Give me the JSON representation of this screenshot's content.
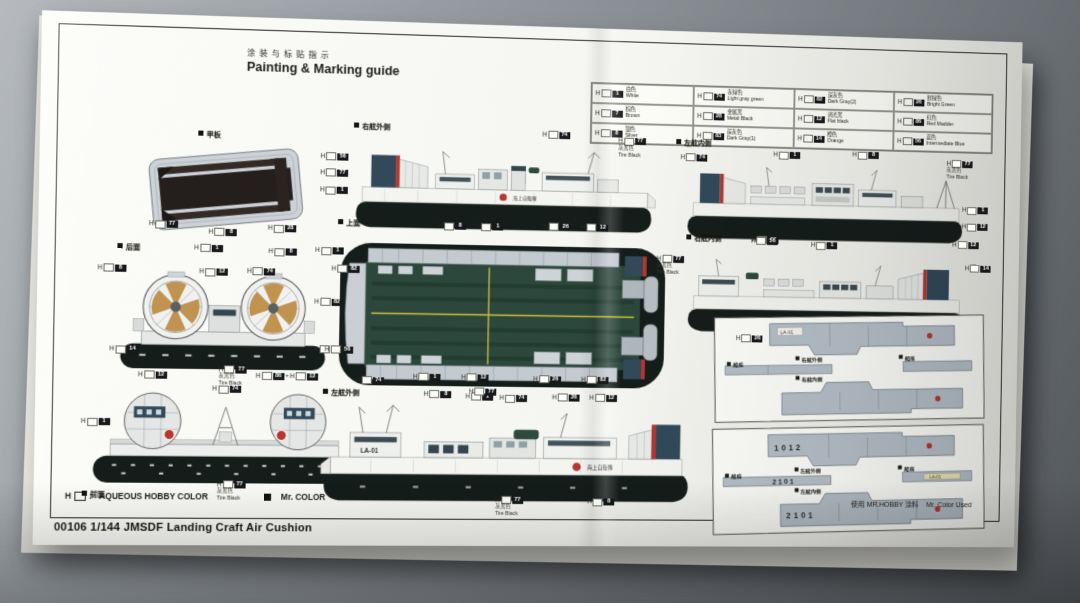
{
  "sheet": {
    "title": {
      "cn": "涂装与标贴指示",
      "en": "Painting & Marking guide"
    },
    "legend": {
      "prefix": "H",
      "aqueous": "AQUEOUS HOBBY COLOR",
      "mr_color": "Mr. COLOR"
    },
    "colors": {
      "skirt_black": "#151d1b",
      "deck_green": "#2c473c",
      "stern_teal": "#32495a",
      "marking_red": "#b5372f",
      "propeller_tan": "#c0934f",
      "lane_yellow": "#d4bf3e"
    },
    "paint_table": {
      "cells": [
        {
          "num": "1",
          "cn": "白色",
          "en": "White"
        },
        {
          "num": "74",
          "cn": "灰绿色",
          "en": "Light gray green"
        },
        {
          "num": "82",
          "cn": "深灰色",
          "en": "Dark Gray(2)"
        },
        {
          "num": "26",
          "cn": "鲜绿色",
          "en": "Bright Green"
        },
        {
          "num": "7",
          "cn": "棕色",
          "en": "Brown"
        },
        {
          "num": "28",
          "cn": "金属黑",
          "en": "Metal Black"
        },
        {
          "num": "12",
          "cn": "消光黑",
          "en": "Flat black"
        },
        {
          "num": "86",
          "cn": "红色",
          "en": "Red Madder"
        },
        {
          "num": "8",
          "cn": "银色",
          "en": "Silver"
        },
        {
          "num": "83",
          "cn": "深灰色",
          "en": "Dark Gray(1)"
        },
        {
          "num": "14",
          "cn": "橙色",
          "en": "Orange"
        },
        {
          "num": "56",
          "cn": "蓝色",
          "en": "Intermediate Blue"
        }
      ]
    },
    "views": {
      "deck": {
        "label": "甲板",
        "callouts": [
          {
            "x": 10,
            "y": 80,
            "num": "77"
          },
          {
            "x": 42,
            "y": 86,
            "num": "8"
          },
          {
            "x": 74,
            "y": 82,
            "num": "28"
          }
        ]
      },
      "starboard_out": {
        "label": "右舷外侧",
        "hull_text": "海上自衛隊",
        "callouts": [
          {
            "x": 1,
            "y": 28,
            "num": "56"
          },
          {
            "x": 1,
            "y": 42,
            "num": "77"
          },
          {
            "x": 1,
            "y": 58,
            "num": "1"
          },
          {
            "x": 64,
            "y": 4,
            "num": "74"
          },
          {
            "x": 86,
            "y": 8,
            "num": "77",
            "note_cn": "灰黑色",
            "note_en": "Tire Black"
          }
        ]
      },
      "port_in": {
        "label": "左舷内侧",
        "callouts": [
          {
            "x": 6,
            "y": 14,
            "num": "74"
          },
          {
            "x": 34,
            "y": 10,
            "num": "1"
          },
          {
            "x": 58,
            "y": 8,
            "num": "8"
          },
          {
            "x": 87,
            "y": 14,
            "num": "77",
            "note_cn": "灰黑色",
            "note_en": "Tire Black"
          },
          {
            "x": 92,
            "y": 58,
            "num": "1"
          },
          {
            "x": 92,
            "y": 74,
            "num": "12"
          },
          {
            "x": 28,
            "y": 90,
            "num": "56"
          }
        ]
      },
      "top": {
        "label": "上面",
        "callouts": [
          {
            "x": 32,
            "y": 1,
            "num": "8"
          },
          {
            "x": 42,
            "y": 1,
            "num": "1"
          },
          {
            "x": 60,
            "y": 0,
            "num": "26"
          },
          {
            "x": 70,
            "y": 0,
            "num": "12"
          },
          {
            "x": 0,
            "y": 16,
            "num": "1"
          },
          {
            "x": 0,
            "y": 44,
            "num": "82"
          },
          {
            "x": 0,
            "y": 70,
            "num": "8"
          },
          {
            "x": 29,
            "y": 94,
            "num": "8"
          },
          {
            "x": 40,
            "y": 95,
            "num": "1"
          },
          {
            "x": 49,
            "y": 96,
            "num": "74"
          },
          {
            "x": 63,
            "y": 95,
            "num": "26"
          },
          {
            "x": 73,
            "y": 95,
            "num": "12"
          }
        ]
      },
      "starboard_in": {
        "label": "右舷内侧",
        "callouts": [
          {
            "x": 0,
            "y": 20,
            "num": "77",
            "note_cn": "灰黑色",
            "note_en": "Tire Black"
          },
          {
            "x": 28,
            "y": 2,
            "num": "56"
          },
          {
            "x": 46,
            "y": 5,
            "num": "1"
          },
          {
            "x": 89,
            "y": 2,
            "num": "12"
          },
          {
            "x": 93,
            "y": 24,
            "num": "14"
          },
          {
            "x": 24,
            "y": 92,
            "num": "26"
          }
        ]
      },
      "rear": {
        "label": "后面",
        "callouts": [
          {
            "x": 38,
            "y": 0,
            "num": "1"
          },
          {
            "x": 66,
            "y": 2,
            "num": "8"
          },
          {
            "x": 2,
            "y": 15,
            "num": "8"
          },
          {
            "x": 40,
            "y": 17,
            "num": "12"
          },
          {
            "x": 58,
            "y": 16,
            "num": "74"
          },
          {
            "x": 90,
            "y": 13,
            "num": "82"
          },
          {
            "x": 7,
            "y": 72,
            "num": "14"
          },
          {
            "x": 88,
            "y": 70,
            "num": "56"
          },
          {
            "x": 48,
            "y": 85,
            "num": "77",
            "note_cn": "灰黑色",
            "note_en": "Tire Black"
          }
        ]
      },
      "front": {
        "label": "前面",
        "callouts": [
          {
            "x": 20,
            "y": 1,
            "num": "12"
          },
          {
            "x": 58,
            "y": 1,
            "num": "86",
            "num2": "12"
          },
          {
            "x": 2,
            "y": 36,
            "num": "1"
          },
          {
            "x": 44,
            "y": 11,
            "num": "74"
          },
          {
            "x": 46,
            "y": 82,
            "num": "77",
            "note_cn": "灰黑色",
            "note_en": "Tire Black"
          }
        ]
      },
      "port_out": {
        "label": "左舷外侧",
        "hull_code": "LA-01",
        "hull_text": "海上自衛隊",
        "callouts": [
          {
            "x": 12,
            "y": 3,
            "num": "74"
          },
          {
            "x": 26,
            "y": 0,
            "num": "1"
          },
          {
            "x": 38,
            "y": 0,
            "num": "12"
          },
          {
            "x": 40,
            "y": 10,
            "num": "77"
          },
          {
            "x": 56,
            "y": 1,
            "num": "26"
          },
          {
            "x": 68,
            "y": 1,
            "num": "82"
          },
          {
            "x": 47,
            "y": 86,
            "num": "77",
            "note_cn": "灰黑色",
            "note_en": "Tire Black"
          },
          {
            "x": 70,
            "y": 87,
            "num": "8"
          }
        ]
      },
      "box1": {
        "marking_tag": "LA-01",
        "parts": [
          {
            "text": "右舷外侧",
            "x": 30,
            "y": 38
          },
          {
            "text": "右舷内侧",
            "x": 30,
            "y": 56
          },
          {
            "text": "船底",
            "x": 5,
            "y": 42
          },
          {
            "text": "船底",
            "x": 68,
            "y": 38
          }
        ]
      },
      "box2": {
        "marking_top": "1012",
        "marking_strip": "2101",
        "marking_bottom": "2101",
        "marking_tag": "LA-01",
        "parts": [
          {
            "text": "左舷外侧",
            "x": 30,
            "y": 38
          },
          {
            "text": "左舷内侧",
            "x": 30,
            "y": 57
          },
          {
            "text": "船底",
            "x": 5,
            "y": 42
          },
          {
            "text": "船底",
            "x": 68,
            "y": 38
          }
        ]
      }
    },
    "footer": {
      "product": "00106 1/144 JMSDF Landing Craft Air Cushion",
      "usage_cn": "使用 MR.HOBBY 涂料",
      "usage_en": "Mr. Color Used"
    }
  }
}
